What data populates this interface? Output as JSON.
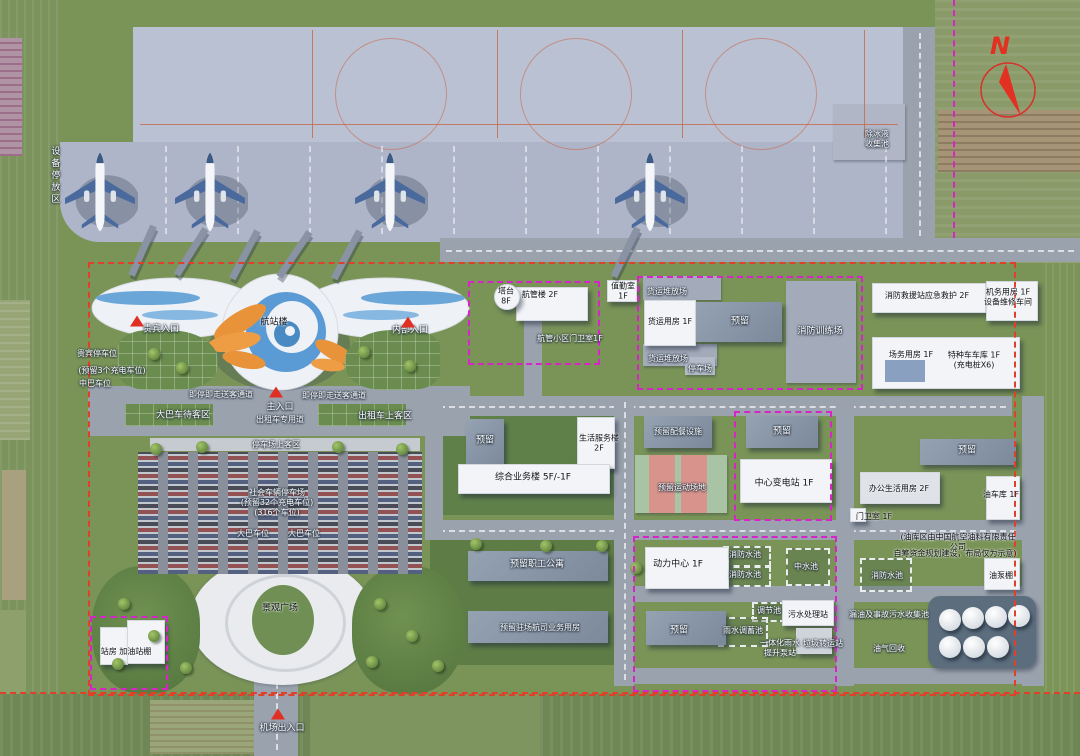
{
  "title": "机场总平面规划鸟瞰图",
  "compass": {
    "label": "N"
  },
  "colors": {
    "boundary_red": "#e0402a",
    "parcel_magenta": "#d823c8",
    "apron_gray": "#bac1d3",
    "grass_green": "#7a9458",
    "building_white": "#f2f4f7",
    "reserved_roof_gray": "#8794a5",
    "terminal_orange": "#e8923a",
    "terminal_blue": "#5b9bd5",
    "marker_red": "#e03024"
  },
  "labels": {
    "equipment_area": "设备停放区",
    "deice_pool": "除冰液\n收集池",
    "vip_entrance": "贵宾入口",
    "internal_entrance": "内部入口",
    "terminal": "航站楼",
    "vip_parking": "贵宾停车位",
    "vip_parking_note": "(预留3个充电车位)",
    "minibus_parking": "中巴车位",
    "dropoff_left": "即停即走送客通道",
    "dropoff_right": "即停即走送客通道",
    "main_entrance": "主入口",
    "bus_wait_area": "大巴车待客区",
    "taxi_lane": "出租车专用道",
    "taxi_pickup": "出租车上客区",
    "lot_pickup": "停车场上客区",
    "social_lot": "社会车辆停车场",
    "social_lot_note1": "(预留32个充电车位)",
    "social_lot_note2": "(316个车位)",
    "bus_spot1": "大巴车位",
    "bus_spot2": "大巴车位",
    "plaza": "景观广场",
    "airport_gate": "机场出入口",
    "gas_station": "站房 加油站棚",
    "tower": "塔台\n8F",
    "atc_building": "航管楼 2F",
    "atc_gatehouse": "航管小区门卫室1F",
    "duty_room": "值勤室\n1F",
    "cargo_yard1": "货运堆放场",
    "cargo_building": "货运用房 1F",
    "cargo_reserve": "预留",
    "fire_training": "消防训练场",
    "cargo_yard2": "货运堆放场",
    "cargo_lot": "停车场",
    "fire_station": "消防救援站应急救护 2F",
    "maintenance": "机务用房 1F\n设备维修车间",
    "ops_building": "场务用房 1F",
    "special_garage": "特种车车库 1F\n(充电桩X6)",
    "reserve_long": "预留",
    "office_life": "办公生活用房 2F",
    "gatehouse": "门卫室 1F",
    "oil_garage": "油车库 1F",
    "reserve_small": "预留",
    "life_services": "生活服务楼\n2F",
    "main_office": "综合业务楼 5F/-1F",
    "catering_reserve": "预留配餐设施",
    "reserve_center": "预留",
    "sports_field": "预留运动场地",
    "substation": "中心变电站 1F",
    "staff_apartments": "预留职工公寓",
    "airline_building": "预留驻场航司业务用房",
    "power_center": "动力中心 1F",
    "reserve_bottom": "预留",
    "fire_pool1": "消防水池",
    "fire_pool2": "消防水池",
    "reclaimed_pool": "中水池",
    "regulating_pool": "调节池",
    "sewage_station": "污水处理站",
    "rainwater_pool": "雨水调蓄池",
    "pump_station": "一体化雨水\n提升泵站",
    "garbage_station": "垃圾转运站",
    "oil_depot_note1": "(油库区由中国航空油料有限责任公司",
    "oil_depot_note2": "自筹资金规划建设，布局仅为示意)",
    "fire_pool3": "消防水池",
    "oil_pump_shed": "油泵棚",
    "leak_pool": "漏油及事故污水收集池",
    "oil_gas_recovery": "油气回收"
  }
}
